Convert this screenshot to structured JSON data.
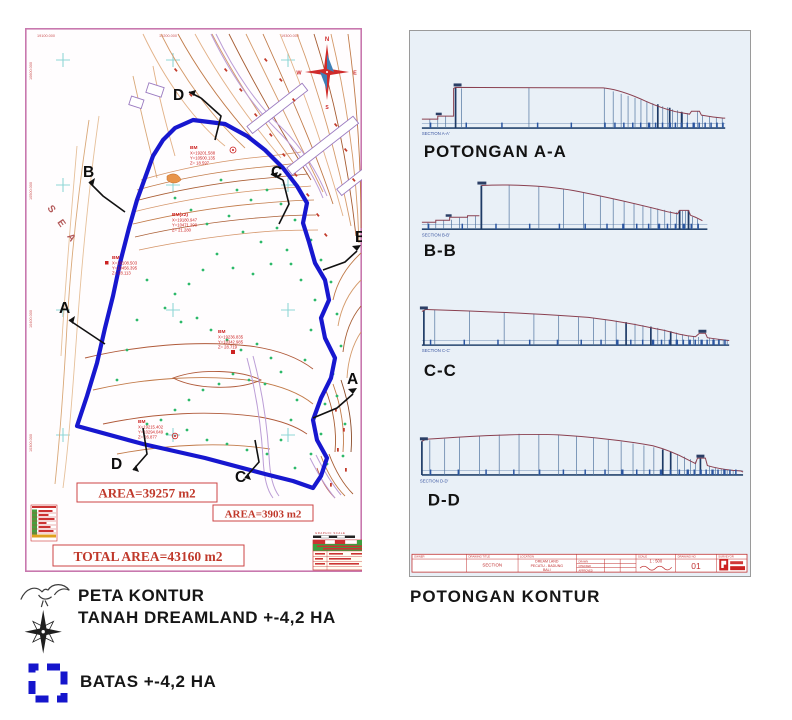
{
  "map": {
    "top_coords": [
      "19100.000",
      "19200.000",
      "19300.000"
    ],
    "left_coords": [
      "10600.000",
      "10500.000",
      "10400.000",
      "10300.000"
    ],
    "sea_label": "S E A",
    "compass": {
      "n": "N",
      "w": "W",
      "e": "E",
      "s": "S"
    },
    "section_letters": {
      "a": "A",
      "b": "B",
      "c": "C",
      "d": "D"
    },
    "bm_markers": [
      {
        "title": "BM",
        "x": "X=19201.588",
        "y": "Y=10500.135",
        "z": "Z=  18.597"
      },
      {
        "title": "BM(x2)",
        "x": "X=19180.947",
        "y": "Y=10471.290",
        "z": "Z=  21.280"
      },
      {
        "title": "BM",
        "x": "X=19108.503",
        "y": "Y=10456.395",
        "z": "Z=  28.113"
      },
      {
        "title": "BM",
        "x": "X=19236.835",
        "y": "Y=10342.985",
        "z": "Z=  28.719"
      },
      {
        "title": "BM",
        "x": "X=19215.402",
        "y": "Y=10294.049",
        "z": "Z=  26.877"
      }
    ],
    "area_label_1": "AREA=39257  m2",
    "area_label_2": "AREA=3903  m2",
    "total_area_label": "TOTAL  AREA=43160  m2",
    "graphic_scale_label": "GRAPHIC  SCALE"
  },
  "sections": {
    "items": [
      {
        "label": "POTONGAN  A-A",
        "sublabel": "SECTION  A-A'"
      },
      {
        "label": "B-B",
        "sublabel": "SECTION  B-B'"
      },
      {
        "label": "C-C",
        "sublabel": "SECTION  C-C'"
      },
      {
        "label": "D-D",
        "sublabel": "SECTION  D-D'"
      }
    ],
    "title_block": {
      "owner_label": "OWNER",
      "drawing_title_label": "DRAWING TITLE",
      "drawing_title_value": "SECTION",
      "location_label": "LOCATION",
      "location_line1": "DREAM LAND",
      "location_line2": "PECATU - BADUNG",
      "location_line3": "BALI",
      "approval_rows": [
        "DRAWN",
        "CHECKED",
        "APPROVED"
      ],
      "scale_label": "SCALE",
      "scale_value": "1 : 500",
      "drawing_no_label": "DRAWING NO",
      "drawing_no_value": "01",
      "surveyor_label": "SURVEYOR"
    },
    "caption": "POTONGAN  KONTUR"
  },
  "legend": {
    "title_line1": "PETA  KONTUR",
    "title_line2": "TANAH  DREAMLAND +-4,2 HA",
    "boundary_label": "BATAS  +-4,2 HA",
    "icons": {
      "map_symbol": "bird-compass-icon",
      "boundary_symbol": "dashed-square-icon"
    }
  },
  "colors": {
    "boundary_blue": "#1717cf",
    "map_frame_pink": "#c878ae",
    "annotation_red": "#c03030",
    "sections_bg": "#e9f0f7"
  }
}
